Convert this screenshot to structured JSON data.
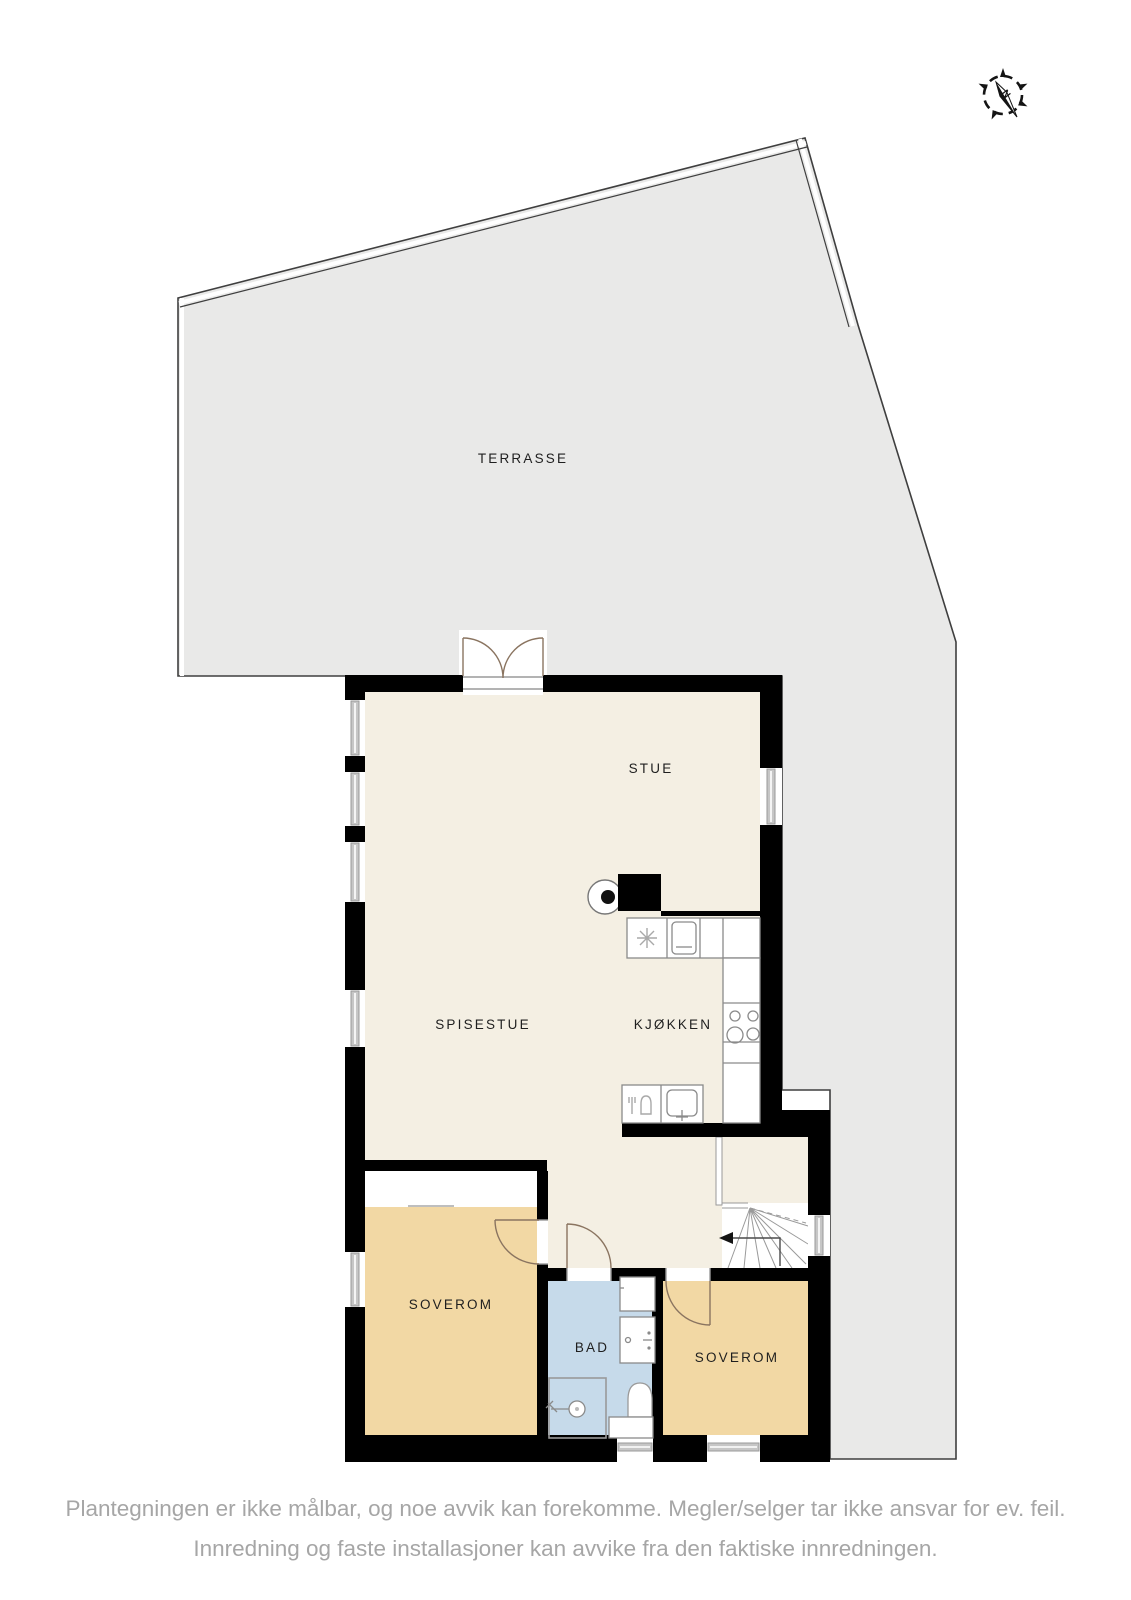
{
  "rooms": {
    "terrasse": "TERRASSE",
    "stue": "STUE",
    "spisestue": "SPISESTUE",
    "kjokken": "KJØKKEN",
    "soverom_left": "SOVEROM",
    "bad": "BAD",
    "soverom_right": "SOVEROM"
  },
  "compass": {
    "north_label": "N"
  },
  "footer": {
    "line1": "Plantegningen er ikke målbar, og noe avvik kan forekomme. Megler/selger tar ikke ansvar for ev. feil.",
    "line2": "Innredning og faste installasjoner kan avvike fra den faktiske innredningen."
  },
  "colors": {
    "wall": "#000000",
    "floor": "#f4efe3",
    "terrace": "#e9e9e8",
    "outline": "#3f3f3f",
    "bedroom": "#f2d8a4",
    "bathroom": "#c6daea",
    "counter_outline": "#8a8a8a",
    "door_arc": "#8a7460",
    "label_text": "#1f1f1f",
    "footer_text": "#a6a6a6"
  }
}
